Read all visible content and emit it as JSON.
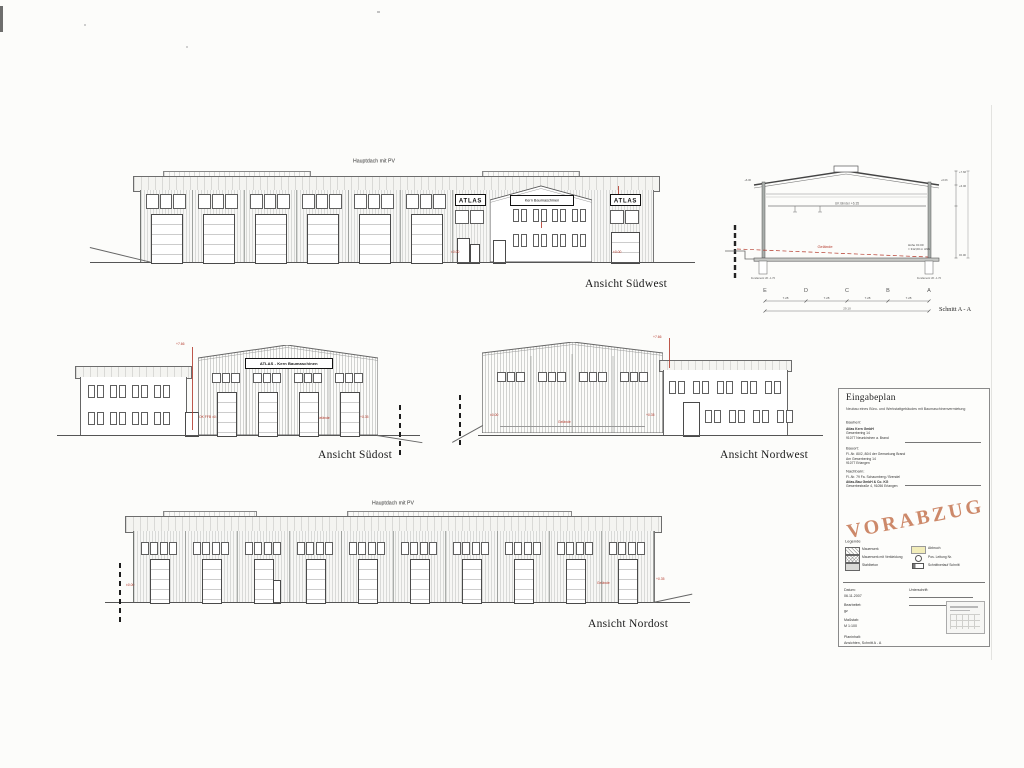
{
  "labels": {
    "hauptdach": "Hauptdach mit PV",
    "ansicht_suedwest": "Ansicht Südwest",
    "ansicht_suedost": "Ansicht Südost",
    "ansicht_nordwest": "Ansicht Nordwest",
    "ansicht_nordost": "Ansicht Nordost",
    "schnitt": "Schnitt A - A"
  },
  "signs": {
    "atlas": "ATLAS",
    "kern": "Kern Baumaschinen",
    "atlas_kern": "ATLAS - Kern Baumaschinen"
  },
  "section": {
    "grid_letters": [
      "E",
      "D",
      "C",
      "B",
      "A"
    ],
    "beam_label": "UK Binder +6.35",
    "terrain_label": "Gelände",
    "height_note_1": "Höhe ±0.00",
    "height_note_2": "= 312,00 m üNN",
    "dim_segments": [
      "7.28",
      "7.28",
      "7.28",
      "7.28"
    ],
    "dim_total": "29.10",
    "apex_dim": "+7.66",
    "eaves_dim": "+6.06",
    "zero_dim": "±0.00",
    "foundation_label": "Fundament UK -1.70"
  },
  "annotations": {
    "sw_left": "±0.00",
    "sw_right": "±0.00",
    "so_top": "+7.66",
    "so_zero": "OK FFB ±0.00",
    "so_gelaende": "Gelände",
    "so_right": "+0.35",
    "nw_top": "+7.66",
    "nw_zero": "±0.00",
    "nw_gelaende": "Gelände",
    "nw_right": "+0.35",
    "no_left": "±0.00",
    "no_mid": "Gelände",
    "no_right": "+0.35"
  },
  "titleblock": {
    "heading": "Eingabeplan",
    "subtitle": "Neubau eines Büro- und Werkstattgebäudes mit Baumaschinenvermietung",
    "bauherr_label": "Bauherr:",
    "bauherr_lines": [
      "Atlas Kern GmbH",
      "Gewerbering 14",
      "91077 Neunkirchen a. Brand"
    ],
    "bauort_label": "Bauort:",
    "bauort_lines": [
      "Fl.-Nr. 80/2, 80/4 der Gemarkung Brand",
      "Am Gewerbering 14",
      "91077 Erlangen"
    ],
    "nachbarn_label": "Nachbarn:",
    "nachbarn_lines": [
      "Fl.-Nr. 79 Fa. Schaumberg / Brendel",
      "Atlas-Bau GmbH & Co. KG",
      "Gewerbestraße 4, 91056 Erlangen"
    ],
    "stamp": "VORABZUG",
    "stamp_color": "#c1764f",
    "legend": {
      "title": "Legende",
      "left": [
        "Mauerwerk",
        "Mauerwerk mit Verkleidung",
        "Stahlbeton"
      ],
      "right": [
        "Abbruch",
        "Pos. Leitung Nr.",
        "Schnittverlauf Schnitt"
      ]
    },
    "fields": {
      "datum_label": "Datum:",
      "datum": "06.11.2007",
      "bearbeitet_label": "Bearbeitet:",
      "bearbeitet": "gz",
      "massstab_label": "Maßstab:",
      "massstab": "M 1:100",
      "planinhalt_label": "Planinhalt:",
      "planinhalt": "Ansichten, Schnitt A - A",
      "unterschrift_label": "Unterschrift:"
    }
  },
  "drawings": {
    "sw_bays": 6,
    "no_bays": 10,
    "so_bays": 4,
    "nw_bays": 4,
    "so_office_windows_per_row": 4,
    "sw_office_windows_per_row": 4,
    "nw_office_row1": 5,
    "nw_office_row2": 4
  }
}
